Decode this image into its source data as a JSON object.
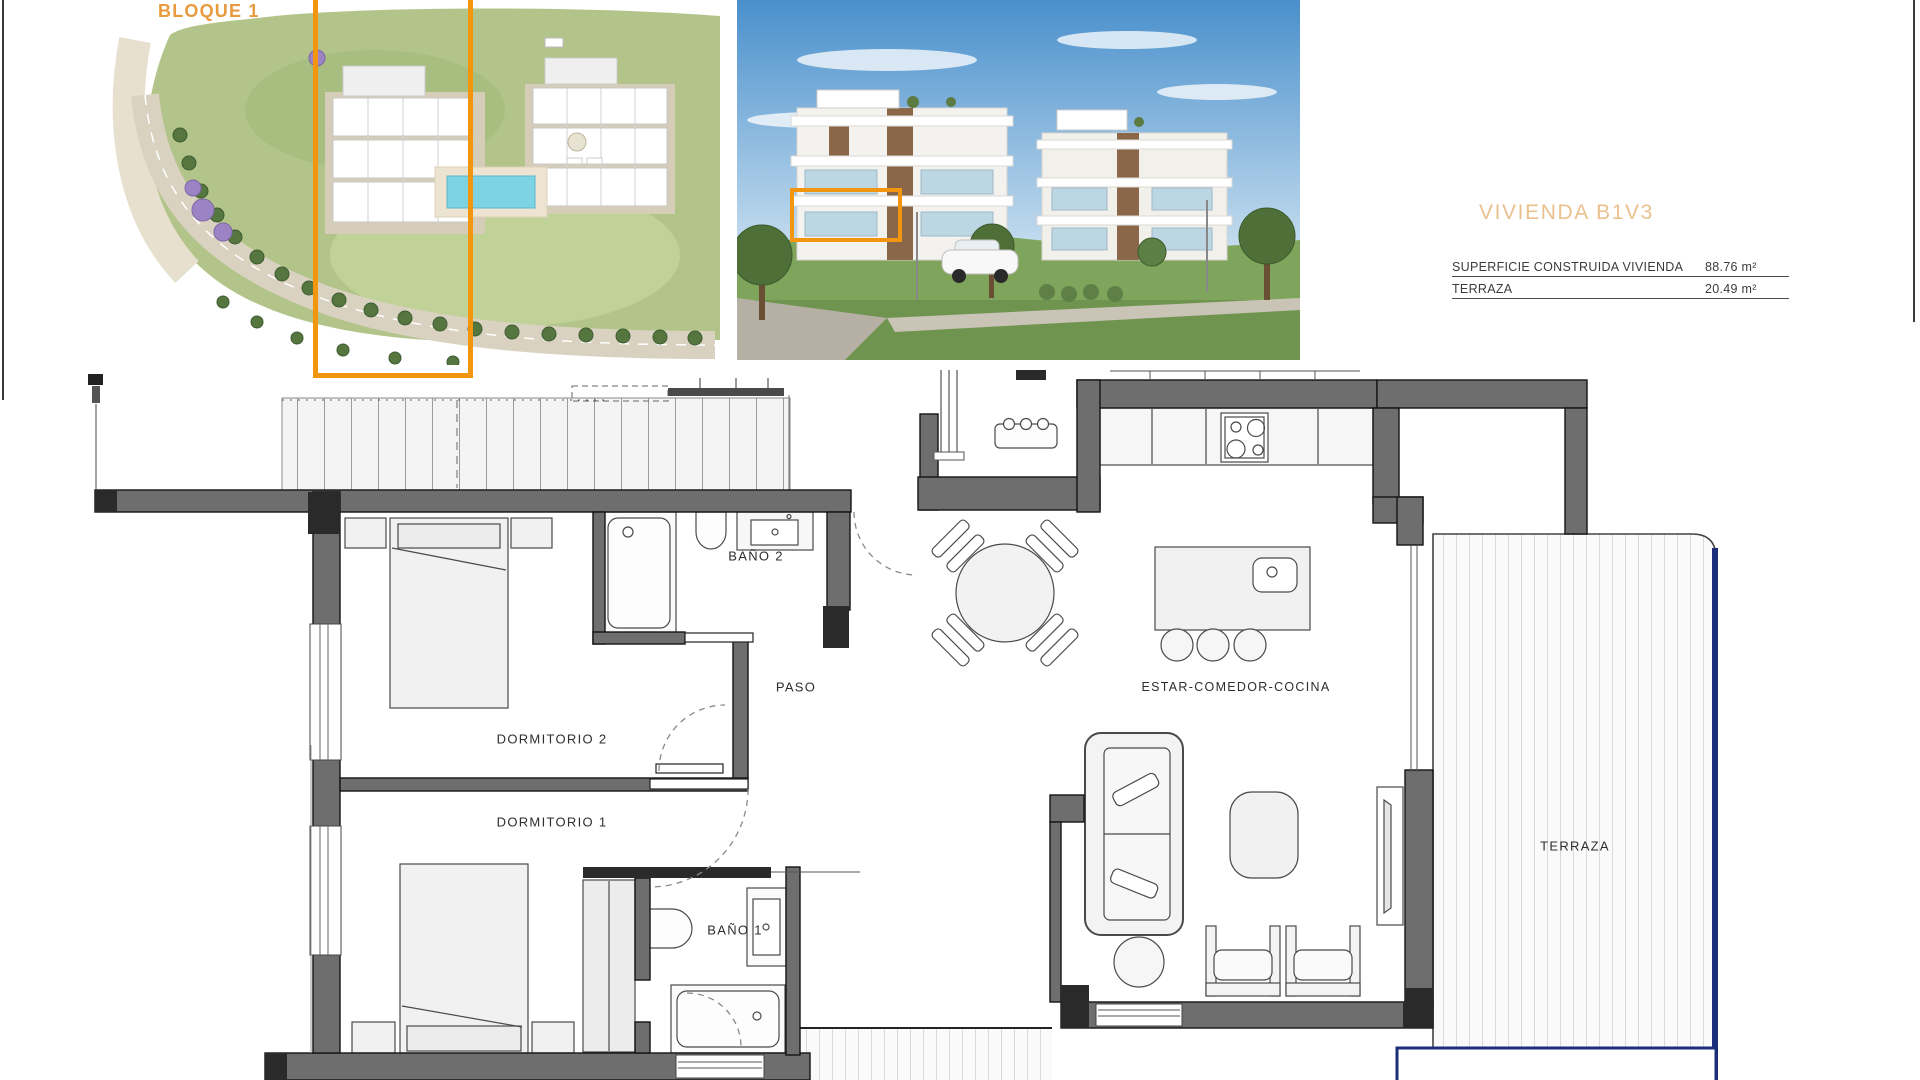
{
  "header": {
    "block_label": "BLOQUE 1",
    "unit_title": "VIVIENDA B1V3",
    "area_table": {
      "rows": [
        {
          "label": "SUPERFICIE CONSTRUIDA VIVIENDA",
          "value": "88.76 m²"
        },
        {
          "label": "TERRAZA",
          "value": "20.49 m²"
        }
      ]
    }
  },
  "floor_plan": {
    "rooms": [
      {
        "id": "bano-2",
        "label": "BAÑO 2"
      },
      {
        "id": "paso",
        "label": "PASO"
      },
      {
        "id": "dormitorio-2",
        "label": "DORMITORIO 2"
      },
      {
        "id": "dormitorio-1",
        "label": "DORMITORIO 1"
      },
      {
        "id": "bano-1",
        "label": "BAÑO 1"
      },
      {
        "id": "estar-comedor-cocina",
        "label": "ESTAR-COMEDOR-COCINA"
      },
      {
        "id": "terraza",
        "label": "TERRAZA"
      }
    ]
  },
  "colors": {
    "accent_orange": "#F2960F",
    "title_tan": "#E9C08E",
    "wall_gray": "#6E6E6E",
    "terrace_navy": "#1C2E79"
  }
}
